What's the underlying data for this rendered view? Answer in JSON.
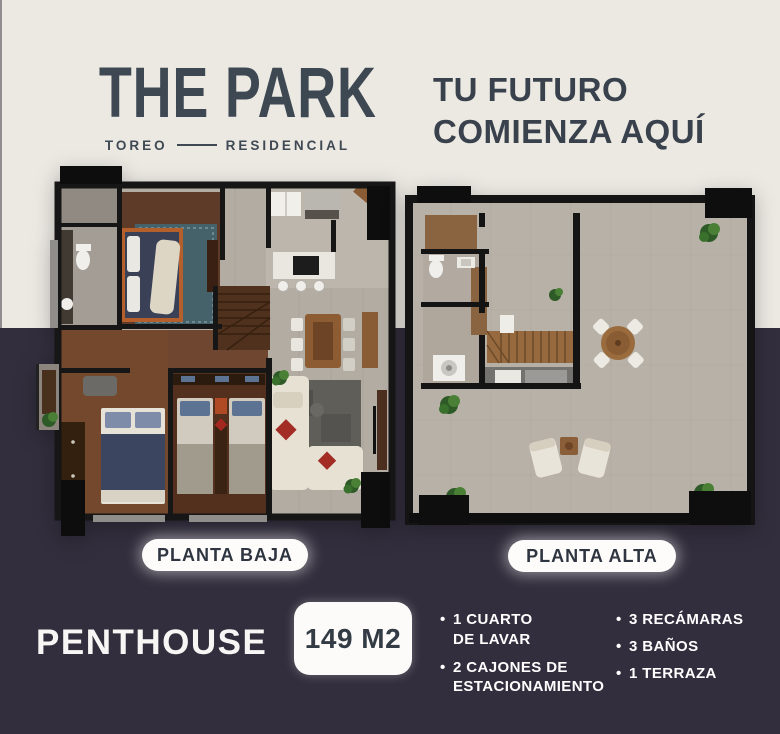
{
  "header": {
    "brand": {
      "title": "THE PARK",
      "sub_left": "TOREO",
      "sub_right": "RESIDENCIAL"
    },
    "tagline": {
      "line1": "TU FUTURO",
      "line2": "COMIENZA AQUÍ"
    }
  },
  "plans": {
    "left": {
      "label": "PLANTA BAJA"
    },
    "right": {
      "label": "PLANTA ALTA"
    }
  },
  "footer": {
    "unit_type": "PENTHOUSE",
    "area": "149 M2",
    "bullet": "•",
    "features_col1": [
      "1 CUARTO\nDE LAVAR",
      "2 CAJONES DE\nESTACIONAMIENTO"
    ],
    "features_col2": [
      "3 RECÁMARAS",
      "3 BAÑOS",
      "1 TERRAZA"
    ]
  },
  "colors": {
    "background_top": "#ECE9E3",
    "background_bottom": "#322E3D",
    "brand_text": "#3E4852",
    "pill_background": "#FFFFFF",
    "pill_text": "#2E3540",
    "badge_background": "#FFFFFF",
    "badge_text": "#333B44",
    "feature_text": "#FFFFFF",
    "wall_black": "#161616"
  }
}
